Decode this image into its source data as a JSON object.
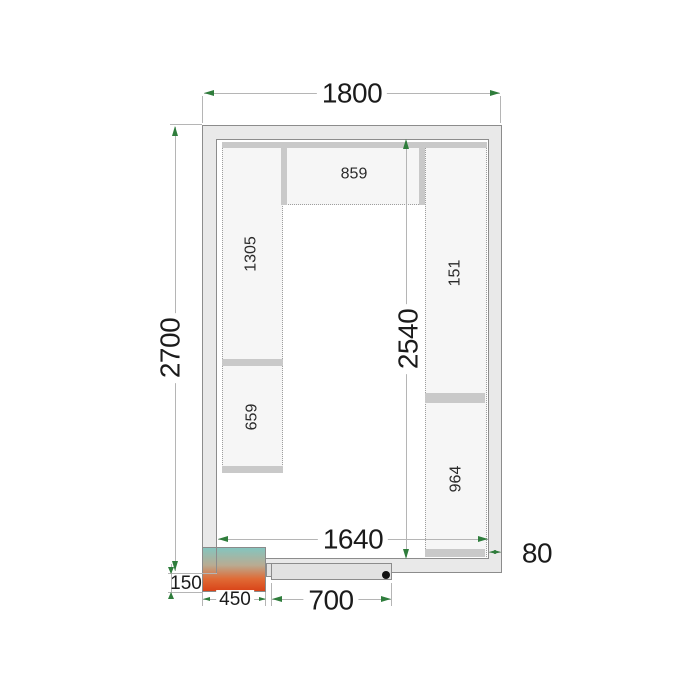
{
  "dims": {
    "outer_width": "1800",
    "outer_height": "2700",
    "inner_width": "1640",
    "inner_height": "2540",
    "wall_thickness": "80",
    "unit_offset": "150",
    "unit_width": "450",
    "door_width": "700"
  },
  "shelves": {
    "top_shelf": "859",
    "left_shelf_upper": "1305",
    "left_shelf_lower": "659",
    "right_shelf_upper": "151",
    "right_shelf_lower": "964"
  },
  "colors": {
    "arrow_green": "#2f7d3c",
    "wall_fill": "#e9e9e9",
    "shelf_fill": "#f6f6f6",
    "rail_fill": "#c9c9c9",
    "dimension_line": "#b5b5b5",
    "unit_gradient_top": "#85c5be",
    "unit_gradient_bottom": "#d94318",
    "door_fill": "#e2e2e2",
    "door_handle": "#111111"
  }
}
